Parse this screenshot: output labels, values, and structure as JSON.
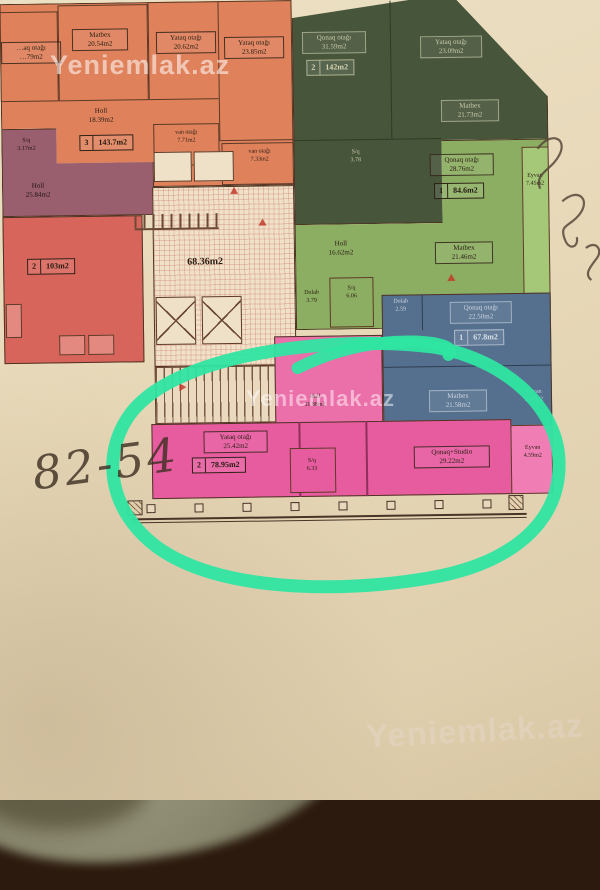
{
  "watermark": {
    "brand": "Yeniemlak.az"
  },
  "handwriting": {
    "price_note": "82-54"
  },
  "core": {
    "hall_area": "68.36m2"
  },
  "units": {
    "orange": {
      "badge": {
        "rooms": "3",
        "area": "143.7m2"
      },
      "rooms": {
        "clipped": {
          "name": "…aq otağı",
          "area": "…79m2"
        },
        "matbex": {
          "name": "Matbex",
          "area": "20.54m2"
        },
        "yataq1": {
          "name": "Yataq otağı",
          "area": "20.62m2"
        },
        "yataq2": {
          "name": "Yataq otağı",
          "area": "23.85m2"
        },
        "holl": {
          "name": "Holl",
          "area": "18.39m2"
        },
        "van1": {
          "name": "van otağı",
          "area": "7.71m2"
        },
        "van2": {
          "name": "van otağı",
          "area": "7.33m2"
        }
      }
    },
    "purple": {
      "rooms": {
        "sq": {
          "name": "S/q",
          "area": "3.17m2"
        },
        "holl": {
          "name": "Holl",
          "area": "25.84m2"
        }
      }
    },
    "red": {
      "badge": {
        "rooms": "2",
        "area": "103m2"
      }
    },
    "dark_green": {
      "badge": {
        "rooms": "2",
        "area": "142m2"
      },
      "rooms": {
        "qonaq": {
          "name": "Qonaq otağı",
          "area": "31.59m2"
        },
        "yataq": {
          "name": "Yataq otağı",
          "area": "23.09m2"
        },
        "matbex": {
          "name": "Matbex",
          "area": "21.73m2"
        },
        "sq": {
          "name": "S/q",
          "area": "3.78"
        }
      }
    },
    "light_green": {
      "badge": {
        "rooms": "1",
        "area": "84.6m2"
      },
      "rooms": {
        "qonaq": {
          "name": "Qonaq otağı",
          "area": "28.76m2"
        },
        "eyvan": {
          "name": "Eyvan",
          "area": "7.45m2"
        },
        "holl": {
          "name": "Holl",
          "area": "16.62m2"
        },
        "matbex": {
          "name": "Matbex",
          "area": "21.46m2"
        },
        "sq": {
          "name": "S/q",
          "area": "6.06"
        },
        "dolab": {
          "name": "Dolab",
          "area": "3.79"
        }
      }
    },
    "blue": {
      "badge": {
        "rooms": "1",
        "area": "67.8m2"
      },
      "rooms": {
        "dolab": {
          "name": "Dolab",
          "area": "2.59"
        },
        "qonaq": {
          "name": "Qonaq otağı",
          "area": "22.50m2"
        },
        "matbex": {
          "name": "Matbex",
          "area": "21.58m2"
        },
        "sq": {
          "name": "S/q",
          "area": ""
        },
        "eyvan": {
          "name": "Eyvan",
          "area": "3.46m2"
        }
      }
    },
    "pink": {
      "badge": {
        "rooms": "2",
        "area": "78.95m2"
      },
      "rooms": {
        "yataq": {
          "name": "Yataq otağı",
          "area": "25.42m2"
        },
        "holl": {
          "name": "Holl",
          "area": "11.88m2"
        },
        "sq": {
          "name": "S/q",
          "area": "6.33"
        },
        "qonaq_studio": {
          "name": "Qonaq+Studio",
          "area": "29.22m2"
        },
        "eyvan": {
          "name": "Eyvan",
          "area": "4.59m2"
        }
      }
    }
  },
  "colors": {
    "marker_circle": "#2fe5a2",
    "orange": "#df815b",
    "purple": "#9a5f6e",
    "red": "#d8655c",
    "dark_green": "#47553b",
    "light_green": "#8cae62",
    "blue": "#55708e",
    "pink": "#e75b9f",
    "paper": "#e6d7b8",
    "table_edge_blue": "#2e4a7c"
  }
}
